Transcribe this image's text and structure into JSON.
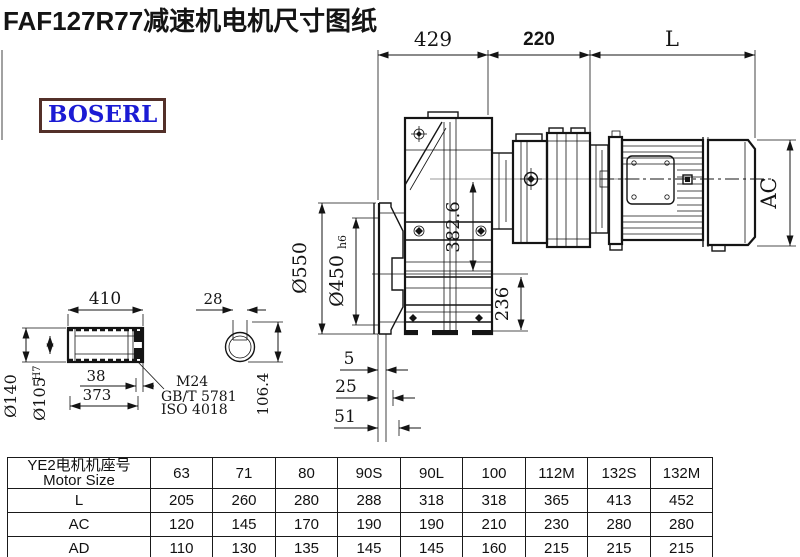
{
  "title": "FAF127R77减速机电机尺寸图纸",
  "logo": "BOSERL",
  "drawing": {
    "dims": {
      "d429": "429",
      "d220": "220",
      "dL": "L",
      "dAC": "AC",
      "d550": "Ø550",
      "d450": "Ø450",
      "d450_suffix": "h6",
      "d382": "382.6",
      "d236": "236",
      "d5": "5",
      "d25": "25",
      "d51": "51",
      "d410": "410",
      "d140": "Ø140",
      "d105": "Ø105",
      "d105_sup": "H7",
      "d38": "38",
      "d373": "373",
      "m24": "M24",
      "gbt": "GB/T 5781",
      "iso": "ISO 4018",
      "d28": "28",
      "d1064": "106.4"
    }
  },
  "table": {
    "header": {
      "line1": "YE2电机机座号",
      "line2": "Motor Size"
    },
    "sizes": [
      "63",
      "71",
      "80",
      "90S",
      "90L",
      "100",
      "112M",
      "132S",
      "132M"
    ],
    "rows": [
      {
        "label": "L",
        "values": [
          "205",
          "260",
          "280",
          "288",
          "318",
          "318",
          "365",
          "413",
          "452"
        ]
      },
      {
        "label": "AC",
        "values": [
          "120",
          "145",
          "170",
          "190",
          "190",
          "210",
          "230",
          "280",
          "280"
        ]
      },
      {
        "label": "AD",
        "values": [
          "110",
          "130",
          "135",
          "145",
          "145",
          "160",
          "215",
          "215",
          "215"
        ]
      }
    ]
  }
}
